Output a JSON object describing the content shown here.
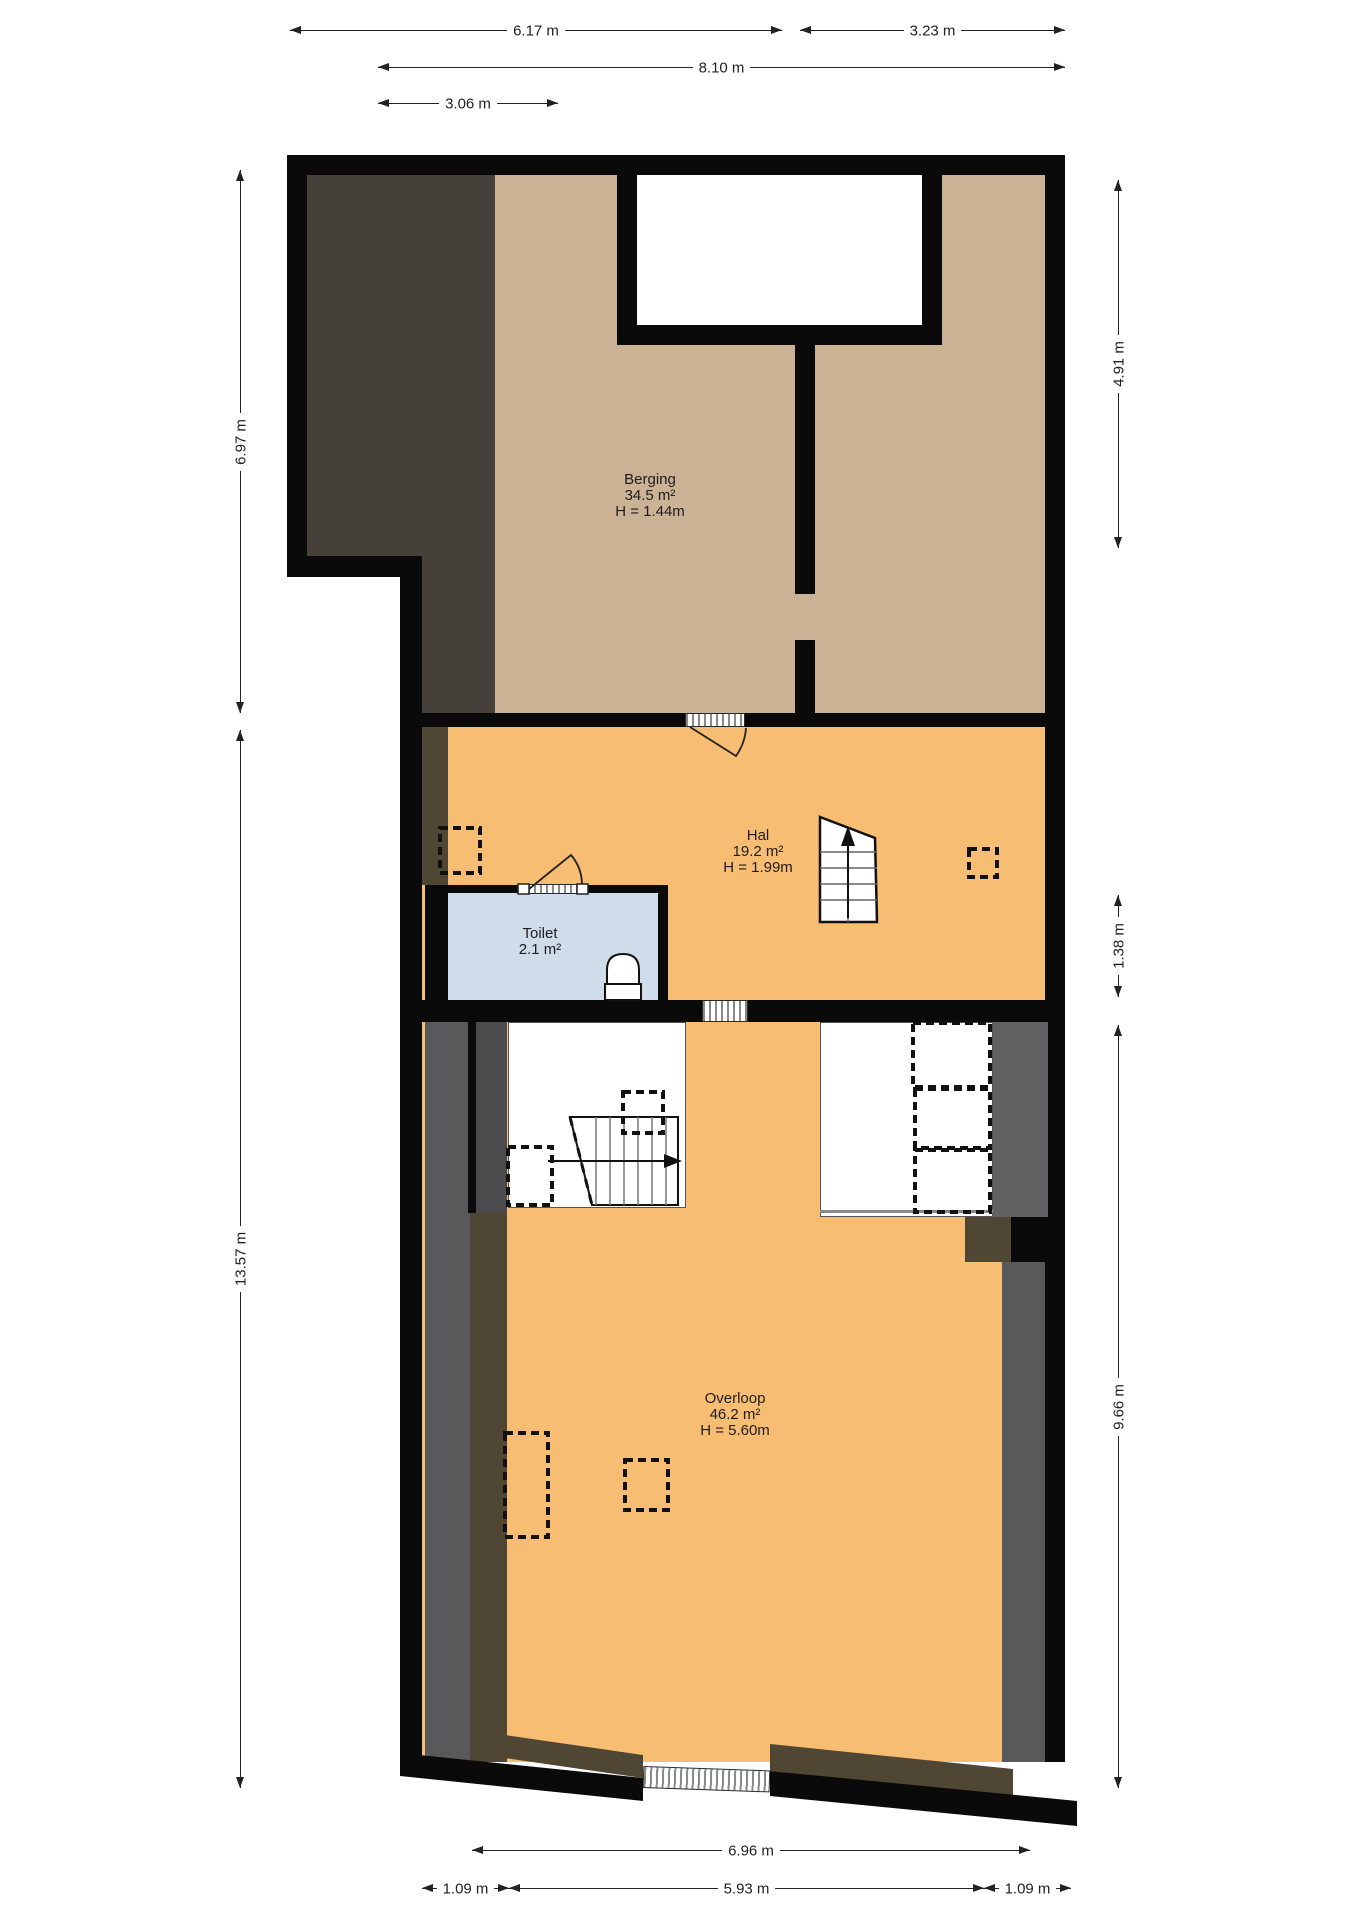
{
  "plan_title": "floor-plan",
  "rooms": [
    {
      "name": "Berging",
      "area": "34.5 m²",
      "height": "H = 1.44m"
    },
    {
      "name": "Hal",
      "area": "19.2 m²",
      "height": "H = 1.99m"
    },
    {
      "name": "Toilet",
      "area": "2.1 m²",
      "height": ""
    },
    {
      "name": "Overloop",
      "area": "46.2 m²",
      "height": "H = 5.60m"
    }
  ],
  "dims": {
    "d1": "6.17 m",
    "d2": "3.23 m",
    "d3": "8.10 m",
    "d4": "3.06 m",
    "d5": "6.97 m",
    "d6": "13.57 m",
    "d7": "4.91 m",
    "d8": "1.38 m",
    "d9": "9.66 m",
    "d10": "6.96 m",
    "d11": "1.09 m",
    "d12": "5.93 m",
    "d13": "1.09 m"
  },
  "colors": {
    "wall": "#0a0a0a",
    "berging_floor": "#cbb294",
    "attic_shadow": "#454039",
    "hal_overloop_floor": "#f7bd73",
    "toilet_floor": "#cfdcea",
    "strip_gray": "#59595b",
    "strip_gray_dark": "#4b4b4d",
    "strip_gray_right": "#626264",
    "strip_olive": "#4f4634"
  },
  "symbols": {
    "staircase_up_arrow": "up",
    "staircase_right_arrow": "right"
  }
}
